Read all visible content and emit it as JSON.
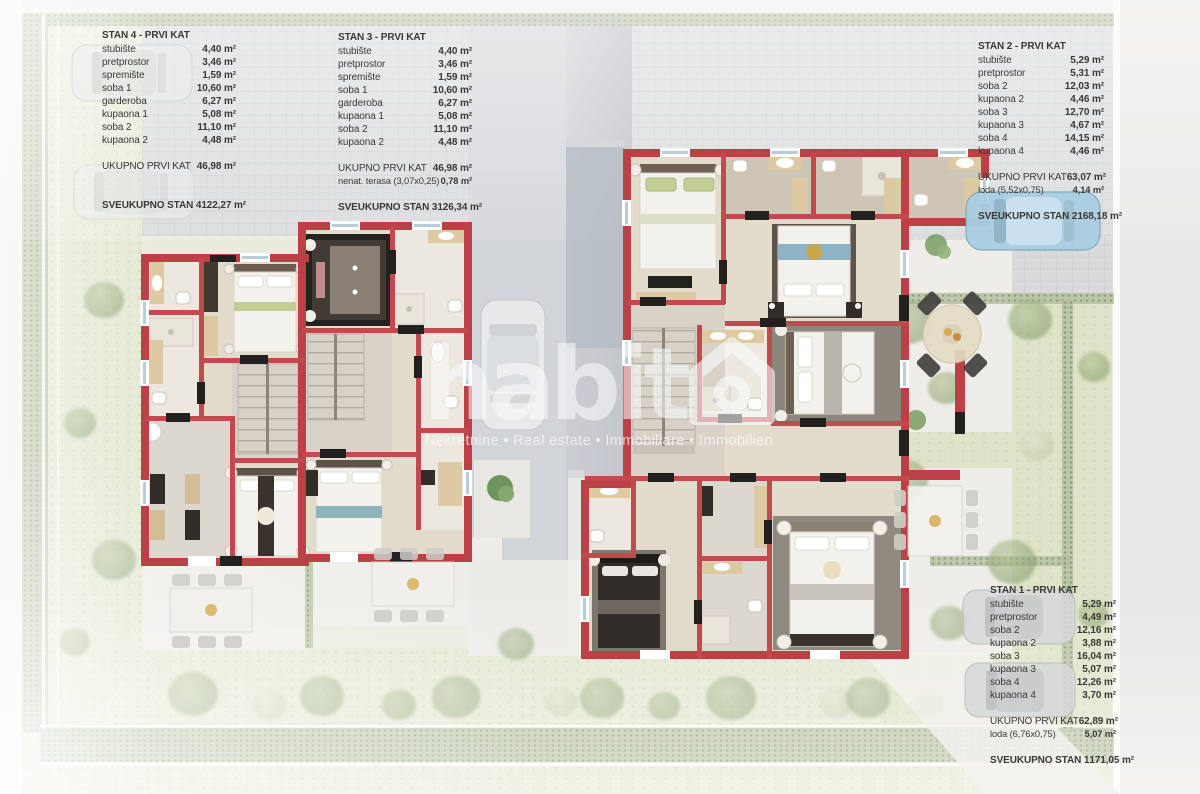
{
  "watermark": {
    "brand": "habito",
    "brand_prefix": "habit",
    "tagline": "Nekretnine • Real estate • Immobiliare • Immobilien"
  },
  "tables": [
    {
      "id": "stan4",
      "title": "STAN 4 - PRVI KAT",
      "rows": [
        {
          "label": "stubište",
          "value": "4,40 m²"
        },
        {
          "label": "pretprostor",
          "value": "3,46 m²"
        },
        {
          "label": "spremište",
          "value": "1,59 m²"
        },
        {
          "label": "soba 1",
          "value": "10,60 m²"
        },
        {
          "label": "garderoba",
          "value": "6,27 m²"
        },
        {
          "label": "kupaona 1",
          "value": "5,08 m²"
        },
        {
          "label": "soba 2",
          "value": "11,10 m²"
        },
        {
          "label": "kupaona 2",
          "value": "4,48 m²"
        }
      ],
      "subtotals": [
        {
          "label": "UKUPNO PRVI KAT",
          "value": "46,98 m²"
        }
      ],
      "grand": {
        "label": "SVEUKUPNO STAN 4",
        "value": "122,27 m²"
      }
    },
    {
      "id": "stan3",
      "title": "STAN 3 - PRVI KAT",
      "rows": [
        {
          "label": "stubište",
          "value": "4,40 m²"
        },
        {
          "label": "pretprostor",
          "value": "3,46 m²"
        },
        {
          "label": "spremište",
          "value": "1,59 m²"
        },
        {
          "label": "soba 1",
          "value": "10,60 m²"
        },
        {
          "label": "garderoba",
          "value": "6,27 m²"
        },
        {
          "label": "kupaona 1",
          "value": "5,08 m²"
        },
        {
          "label": "soba 2",
          "value": "11,10 m²"
        },
        {
          "label": "kupaona 2",
          "value": "4,48 m²"
        }
      ],
      "subtotals": [
        {
          "label": "UKUPNO PRVI KAT",
          "value": "46,98 m²"
        },
        {
          "label": "nenat. terasa  (3,07x0,25)",
          "value": "0,78 m²"
        }
      ],
      "grand": {
        "label": "SVEUKUPNO STAN 3",
        "value": "126,34 m²"
      }
    },
    {
      "id": "stan2",
      "title": "STAN 2 - PRVI KAT",
      "rows": [
        {
          "label": "stubište",
          "value": "5,29 m²"
        },
        {
          "label": "pretprostor",
          "value": "5,31 m²"
        },
        {
          "label": "soba 2",
          "value": "12,03 m²"
        },
        {
          "label": "kupaona 2",
          "value": "4,46 m²"
        },
        {
          "label": "soba 3",
          "value": "12,70 m²"
        },
        {
          "label": "kupaona 3",
          "value": "4,67 m²"
        },
        {
          "label": "soba 4",
          "value": "14,15 m²"
        },
        {
          "label": "kupaona 4",
          "value": "4,46 m²"
        }
      ],
      "subtotals": [
        {
          "label": "UKUPNO PRVI KAT",
          "value": "63,07 m²"
        },
        {
          "label": "loda  (5,52x0,75)",
          "value": "4,14 m²"
        }
      ],
      "grand": {
        "label": "SVEUKUPNO STAN 2",
        "value": "168,18 m²"
      }
    },
    {
      "id": "stan1",
      "title": "STAN 1 - PRVI KAT",
      "rows": [
        {
          "label": "stubište",
          "value": "5,29 m²"
        },
        {
          "label": "pretprostor",
          "value": "4,49 m²"
        },
        {
          "label": "soba 2",
          "value": "12,16 m²"
        },
        {
          "label": "kupaona 2",
          "value": "3,88 m²"
        },
        {
          "label": "soba 3",
          "value": "16,04 m²"
        },
        {
          "label": "kupaona 3",
          "value": "5,07 m²"
        },
        {
          "label": "soba 4",
          "value": "12,26 m²"
        },
        {
          "label": "kupaona 4",
          "value": "3,70 m²"
        }
      ],
      "subtotals": [
        {
          "label": "UKUPNO PRVI KAT",
          "value": "62,89 m²"
        },
        {
          "label": "loda  (6,76x0,75)",
          "value": "5,07 m²"
        }
      ],
      "grand": {
        "label": "SVEUKUPNO STAN 1",
        "value": "171,05 m²"
      }
    }
  ],
  "palette": {
    "wall_red": "#bc4146",
    "floor_beige": "#e3dbcc",
    "lawn_green": "#e5e8d3",
    "hedge_green": "#b5c1a2",
    "pavement_gray": "#d9dadc",
    "car_blue": "#a9cfe2",
    "table_text": "#3a3937",
    "watermark_white": "rgba(249,250,251,0.6)"
  }
}
